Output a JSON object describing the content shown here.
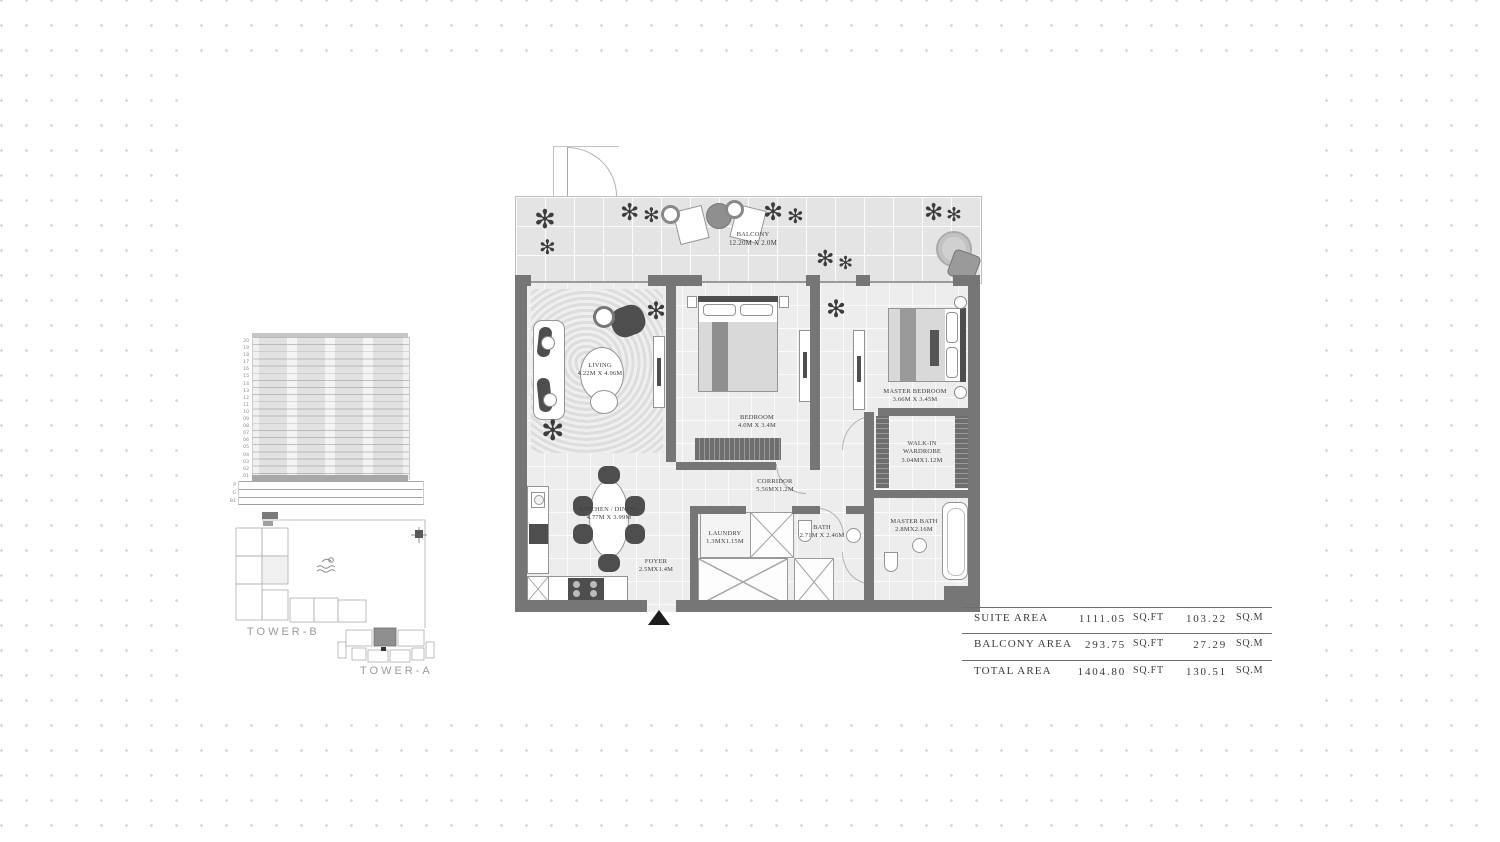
{
  "key_plan": {
    "elevation_floors": [
      "20",
      "19",
      "18",
      "17",
      "16",
      "15",
      "14",
      "13",
      "12",
      "11",
      "10",
      "09",
      "08",
      "07",
      "06",
      "05",
      "04",
      "03",
      "02",
      "01"
    ],
    "elevation_podium": [
      "P",
      "G",
      "B1"
    ],
    "tower_b_label": "TOWER-B",
    "tower_a_label": "TOWER-A"
  },
  "floor_plan": {
    "rooms": {
      "balcony": {
        "label": "BALCONY",
        "dims": "12.20M X 2.0M"
      },
      "living": {
        "label": "LIVING",
        "dims": "4.22M X 4.96M"
      },
      "bedroom": {
        "label": "BEDROOM",
        "dims": "4.0M X 3.4M"
      },
      "master_bedroom": {
        "label": "MASTER BEDROOM",
        "dims": "3.66M X 3.45M"
      },
      "walk_in_wardrobe": {
        "label": "WALK-IN WARDROBE",
        "dims": "3.04MX1.12M"
      },
      "corridor": {
        "label": "CORRIDOR",
        "dims": "5.56MX1.2M"
      },
      "kitchen_dining": {
        "label": "KITCHEN / DINING",
        "dims": "4.77M X 3.99M"
      },
      "laundry": {
        "label": "LAUNDRY",
        "dims": "1.3MX1.15M"
      },
      "foyer": {
        "label": "FOYER",
        "dims": "2.5MX1.4M"
      },
      "bath": {
        "label": "BATH",
        "dims": "2.71M X 2.46M"
      },
      "master_bath": {
        "label": "MASTER BATH",
        "dims": "2.8MX2.16M"
      }
    }
  },
  "area_table": {
    "rows": [
      {
        "label": "SUITE AREA",
        "sqft_value": "1111.05",
        "sqft_unit": "SQ.FT",
        "sqm_value": "103.22",
        "sqm_unit": "SQ.M"
      },
      {
        "label": "BALCONY AREA",
        "sqft_value": "293.75",
        "sqft_unit": "SQ.FT",
        "sqm_value": "27.29",
        "sqm_unit": "SQ.M"
      },
      {
        "label": "TOTAL AREA",
        "sqft_value": "1404.80",
        "sqft_unit": "SQ.FT",
        "sqm_value": "130.51",
        "sqm_unit": "SQ.M"
      }
    ]
  },
  "icons": {
    "plant_glyph": "✻"
  },
  "colors": {
    "wall": "#767676",
    "balcony_floor": "#e4e4e4",
    "interior_floor": "#ededed",
    "furniture_dark": "#4e4e4e",
    "label_text": "#3f3f3f",
    "dots": "#d4d4d4",
    "tower_label_text": "#9b9b9b",
    "highlighted_unit": "#8f8f8f",
    "entry_marker": "#1c1c1c"
  }
}
